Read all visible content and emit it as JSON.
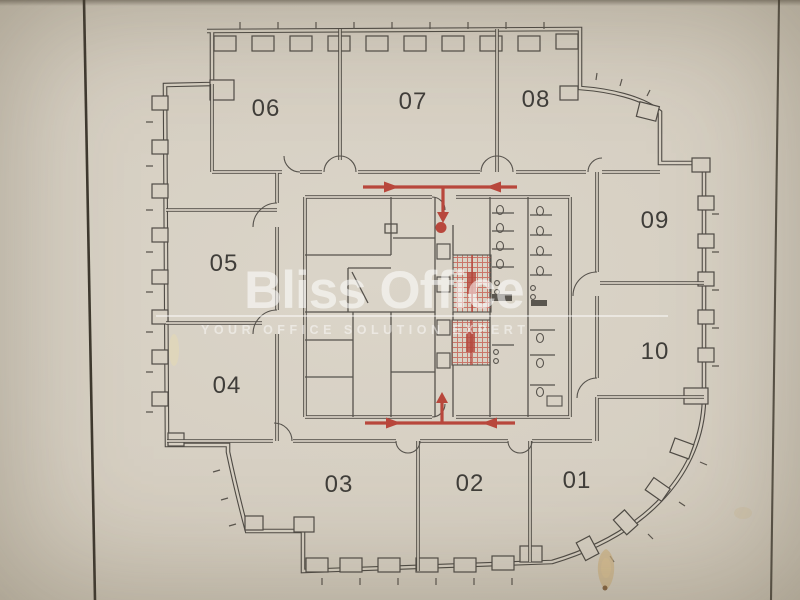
{
  "photo": {
    "paper_color": "#d6cfc2",
    "ink_color": "#4e4a44",
    "accent_red": "#b8473c",
    "watermark_color": "#ffffff",
    "stain_color": "#cdb283"
  },
  "watermark": {
    "brand": "Bliss Office",
    "tagline": "YOUR OFFICE SOLUTION EXPERT"
  },
  "floor_plan": {
    "units": [
      {
        "label": "06"
      },
      {
        "label": "07"
      },
      {
        "label": "08"
      },
      {
        "label": "09"
      },
      {
        "label": "10"
      },
      {
        "label": "05"
      },
      {
        "label": "04"
      },
      {
        "label": "03"
      },
      {
        "label": "02"
      },
      {
        "label": "01"
      }
    ],
    "annotations": [
      "entry-route-north",
      "entry-route-south",
      "entry-point-dot",
      "stairwell-hatch-upper",
      "stairwell-hatch-lower"
    ]
  }
}
